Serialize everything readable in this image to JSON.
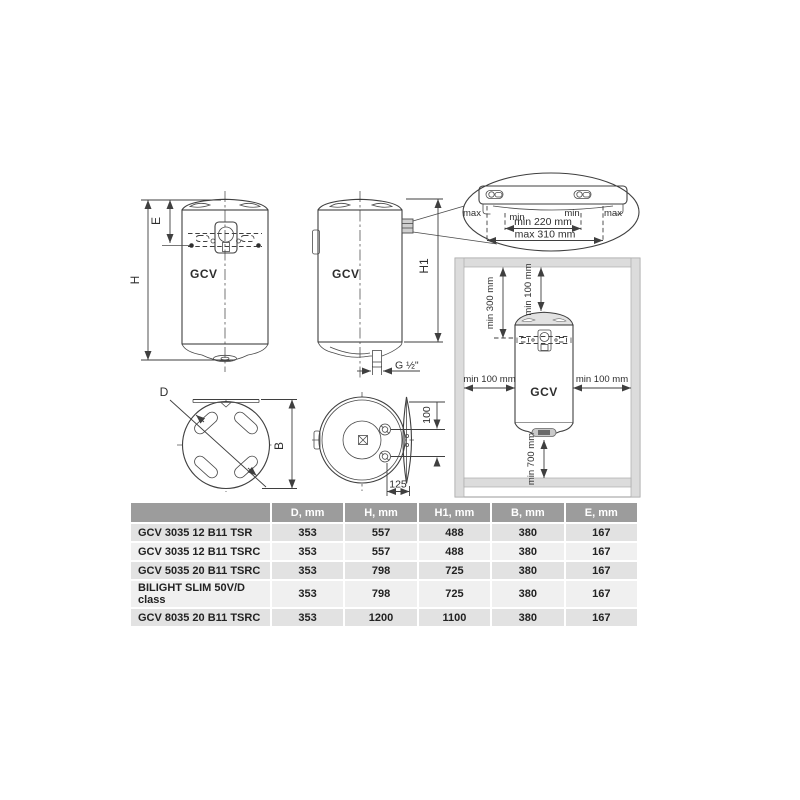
{
  "drawings": {
    "front": {
      "label": "GCV",
      "dim_h": "H",
      "dim_e": "E"
    },
    "side": {
      "label": "GCV",
      "dim_h1": "H1",
      "dim_g": "G ½\""
    },
    "bracket_detail": {
      "max_left": "max",
      "min_left": "min",
      "min_right": "min",
      "max_right": "max",
      "min_span": "min 220 mm",
      "max_span": "max 310 mm"
    },
    "installation": {
      "label": "GCV",
      "top_left": "min 300 mm",
      "top_center": "min 100 mm",
      "left": "min 100 mm",
      "right": "min 100 mm",
      "bottom": "min 700 mm"
    },
    "top_view": {
      "dim_d": "D",
      "dim_b": "B"
    },
    "bottom_view": {
      "dim_100": "100",
      "dim_125": "125"
    }
  },
  "table": {
    "headers": [
      "",
      "D, mm",
      "H, mm",
      "H1, mm",
      "B, mm",
      "E, mm"
    ],
    "rows": [
      {
        "model": "GCV 3035 12 B11 TSR",
        "values": [
          "353",
          "557",
          "488",
          "380",
          "167"
        ]
      },
      {
        "model": "GCV 3035 12 B11 TSRC",
        "values": [
          "353",
          "557",
          "488",
          "380",
          "167"
        ]
      },
      {
        "model": "GCV 5035 20 B11 TSRC",
        "values": [
          "353",
          "798",
          "725",
          "380",
          "167"
        ]
      },
      {
        "model": "BILIGHT SLIM 50V/D class",
        "values": [
          "353",
          "798",
          "725",
          "380",
          "167"
        ]
      },
      {
        "model": "GCV 8035 20 B11 TSRC",
        "values": [
          "353",
          "1200",
          "1100",
          "380",
          "167"
        ]
      }
    ]
  },
  "colors": {
    "line": "#3f3f3f",
    "table_header_bg": "#9c9c9c",
    "row_odd": "#e2e2e2",
    "row_even": "#f0f0f0",
    "wall": "#dcdcdc"
  }
}
